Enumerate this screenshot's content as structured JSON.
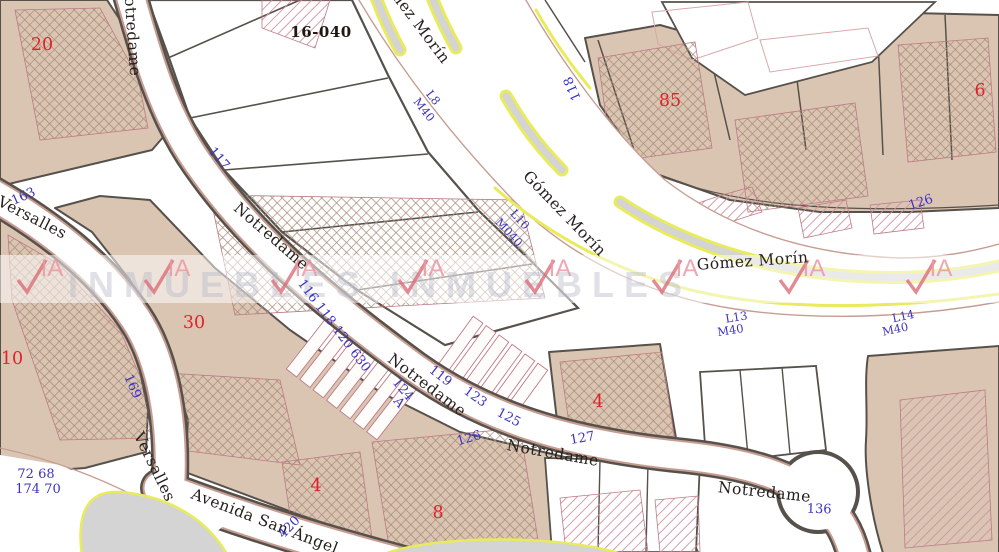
{
  "map": {
    "block_code": "16-040",
    "streets": {
      "notredame": "Notredame",
      "gomez_morin": "Gómez Morín",
      "versalles": "Versalles",
      "avenida_san_angel": "Avenida San Ángel"
    },
    "parcel_numbers": {
      "p20": "20",
      "p85": "85",
      "p6": "6",
      "p30": "30",
      "p10": "10",
      "p4_center": "4",
      "p4_south": "4",
      "p8": "8"
    },
    "address_numbers": {
      "n117": "117",
      "n163": "163",
      "n169": "169",
      "n118": "118",
      "n126_ne": "126",
      "n_seq": "116 118 120 630",
      "n119": "119",
      "n123": "123",
      "n125": "125",
      "n124": "124",
      "nA": "A",
      "n126_s": "126",
      "n127": "127",
      "n136": "136",
      "n420": "420",
      "n72_68": "72 68",
      "n174_70": "174 70"
    },
    "lot_labels": {
      "l8": "L8",
      "l8_m": "M40",
      "l10": "L10",
      "l10_m": "M040",
      "l13": "L13",
      "l13_m": "M40",
      "l14": "L14",
      "l14_m": "M40"
    },
    "watermark": {
      "brand_ia": "IA",
      "band_text": "INMUEBLES INMUEBLES"
    },
    "colors": {
      "parcel_tan": "#dac5b2",
      "parcel_border": "#57514b",
      "road_edge_pink": "#c79d92",
      "lane_yellow": "#e8eb5c",
      "median_gray": "#d4d4d4",
      "address_blue": "#3b33c0",
      "parcel_red": "#e2202c"
    }
  }
}
